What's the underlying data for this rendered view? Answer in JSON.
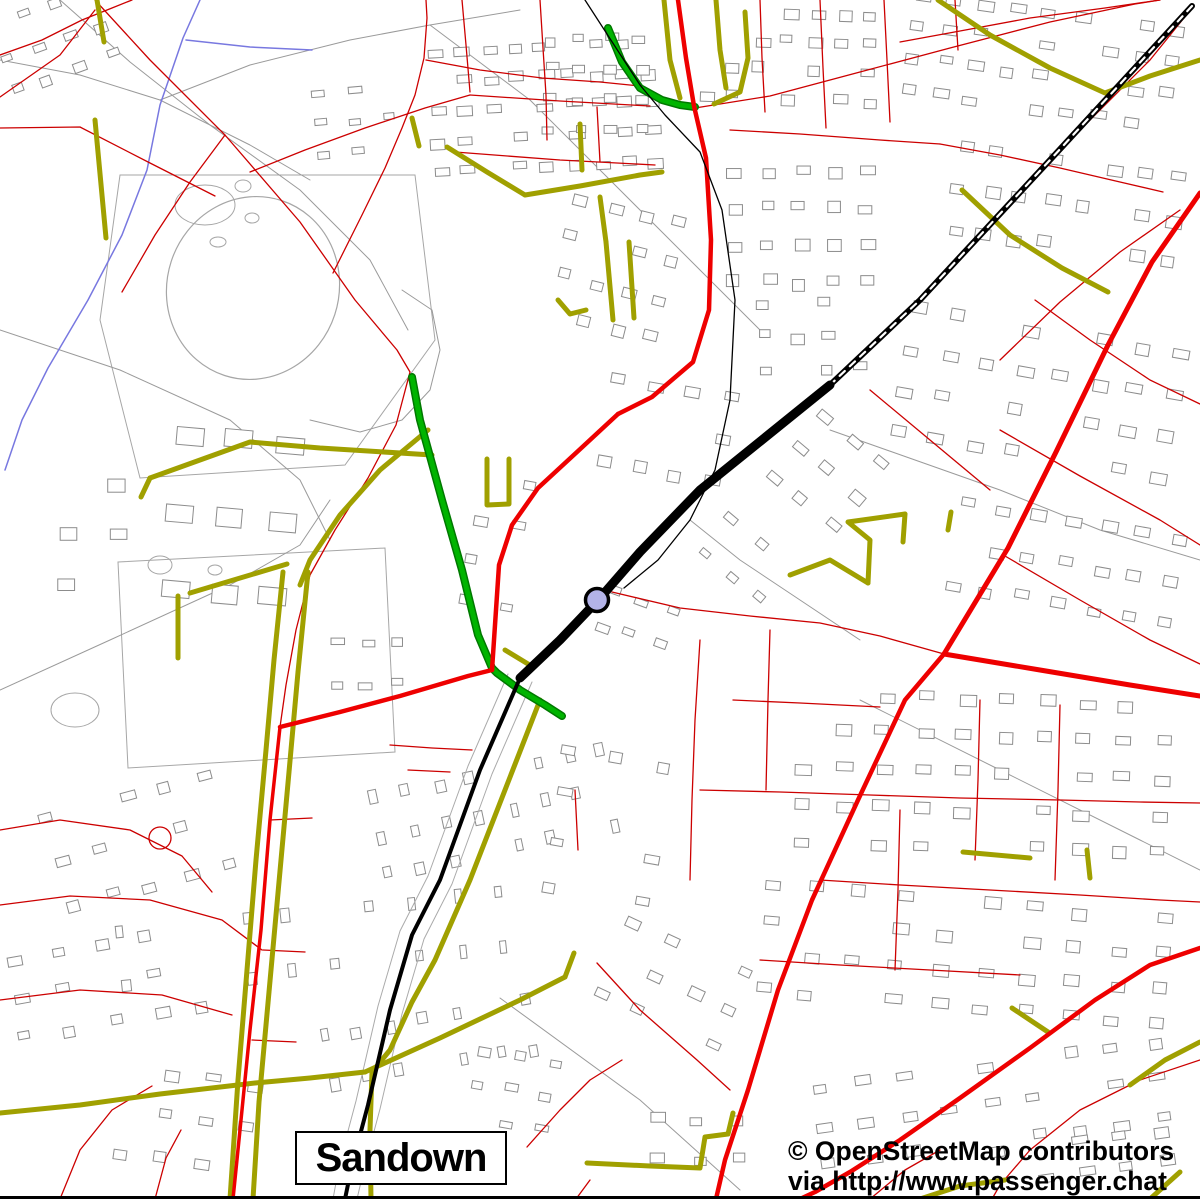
{
  "map_view": {
    "width": 1200,
    "height": 1199,
    "place_label": "Sandown",
    "attribution_line1": "© OpenStreetMap contributors",
    "attribution_line2": "via http://www.passenger.chat",
    "palette": {
      "background": "#ffffff",
      "building": "#8c8c8c",
      "path_gray": "#9a9a9a",
      "field_gray": "#a6a6a6",
      "minor_road": "#cc0000",
      "major_road": "#ee0000",
      "secondary_road": "#a0a000",
      "tertiary_green": "#00b400",
      "tertiary_green_edge": "#007800",
      "railway": "#000000",
      "stream": "#7878e0",
      "marker_fill": "#b3b3e8",
      "marker_stroke": "#000000"
    },
    "station_marker": {
      "x": 597,
      "y": 600,
      "r": 11.5,
      "stroke_width": 3.5
    },
    "layers": {
      "streams": [
        "200,0 183,38 160,105 147,170 122,235 88,300 48,368 22,420 5,470",
        "186,40 250,47 312,50"
      ],
      "fields": [
        "120,175 415,175 435,340 345,465 140,478 100,320",
        "118,562 385,548 395,752 128,768"
      ],
      "oval_track": {
        "cx": 253,
        "cy": 288,
        "rx": 86,
        "ry": 92,
        "rotate": 18
      },
      "ponds": [
        [
          205,
          205,
          30,
          20
        ],
        [
          243,
          186,
          8,
          6
        ],
        [
          252,
          218,
          7,
          5
        ],
        [
          218,
          242,
          8,
          5
        ],
        [
          160,
          565,
          12,
          9
        ],
        [
          75,
          710,
          24,
          17
        ],
        [
          215,
          570,
          7,
          5
        ]
      ],
      "paths": [
        "60,0 130,62 210,125 300,190 370,260 408,330",
        "0,60 80,75 160,100 250,145 310,180",
        "160,100 250,65 350,40 430,25 520,10",
        "0,330 120,370 230,420 300,480 330,540",
        "0,690 110,640 230,585 300,545 330,500",
        "500,998 640,1100 740,1190",
        "310,420 360,432 402,420 430,390 440,350 432,310 402,290",
        "430,25 530,100 620,190 700,270 760,330",
        "830,430 1000,490 1100,530 1200,560",
        "860,700 1000,770 1140,840 1200,870",
        "690,520 740,560 800,600 860,640"
      ],
      "building_clusters": [
        [
          432,
          42,
          240,
          150,
          -3,
          5,
          9,
          14,
          9
        ],
        [
          700,
          8,
          190,
          115,
          2,
          4,
          7,
          13,
          9
        ],
        [
          905,
          8,
          290,
          130,
          8,
          4,
          9,
          14,
          9
        ],
        [
          950,
          158,
          245,
          125,
          8,
          3,
          8,
          14,
          10
        ],
        [
          728,
          168,
          165,
          145,
          0,
          4,
          5,
          13,
          10
        ],
        [
          556,
          208,
          135,
          155,
          14,
          4,
          4,
          12,
          10
        ],
        [
          600,
          385,
          150,
          125,
          10,
          3,
          4,
          14,
          10
        ],
        [
          758,
          298,
          125,
          100,
          0,
          3,
          4,
          12,
          9
        ],
        [
          898,
          328,
          300,
          165,
          10,
          4,
          8,
          15,
          10
        ],
        [
          948,
          518,
          250,
          125,
          10,
          3,
          7,
          14,
          10
        ],
        [
          770,
          430,
          115,
          120,
          40,
          3,
          3,
          13,
          9
        ],
        [
          795,
          695,
          400,
          185,
          2,
          5,
          10,
          15,
          10
        ],
        [
          758,
          898,
          440,
          140,
          5,
          4,
          10,
          15,
          10
        ],
        [
          818,
          1058,
          380,
          115,
          -8,
          3,
          9,
          14,
          9
        ],
        [
          428,
          695,
          115,
          265,
          78,
          8,
          3,
          12,
          8
        ],
        [
          548,
          755,
          145,
          185,
          10,
          4,
          3,
          13,
          9
        ],
        [
          598,
          945,
          165,
          120,
          25,
          3,
          4,
          13,
          9
        ],
        [
          372,
          945,
          95,
          235,
          80,
          7,
          2,
          12,
          8
        ],
        [
          240,
          755,
          115,
          420,
          84,
          10,
          2,
          12,
          8
        ],
        [
          55,
          785,
          205,
          140,
          -15,
          3,
          5,
          13,
          9
        ],
        [
          15,
          935,
          225,
          120,
          -10,
          3,
          5,
          13,
          9
        ],
        [
          115,
          1075,
          165,
          125,
          8,
          3,
          4,
          13,
          9
        ],
        [
          165,
          432,
          150,
          230,
          5,
          3,
          3,
          26,
          18
        ],
        [
          425,
          475,
          125,
          165,
          10,
          4,
          3,
          12,
          8
        ],
        [
          0,
          0,
          135,
          100,
          -20,
          3,
          4,
          12,
          8
        ],
        [
          315,
          85,
          105,
          95,
          -5,
          3,
          3,
          12,
          8
        ],
        [
          995,
          1135,
          205,
          62,
          -8,
          2,
          5,
          14,
          9
        ],
        [
          470,
          1055,
          105,
          100,
          10,
          3,
          3,
          12,
          8
        ],
        [
          650,
          1115,
          125,
          80,
          0,
          2,
          3,
          13,
          9
        ],
        [
          545,
          35,
          120,
          120,
          0,
          4,
          4,
          11,
          8
        ],
        [
          595,
          600,
          90,
          70,
          20,
          2,
          3,
          12,
          8
        ],
        [
          690,
          540,
          110,
          80,
          40,
          2,
          3,
          12,
          8
        ],
        [
          330,
          640,
          90,
          80,
          0,
          2,
          3,
          12,
          8
        ],
        [
          60,
          430,
          100,
          200,
          0,
          4,
          2,
          16,
          12
        ]
      ],
      "minor_roads": [
        "0,97 60,55 95,10",
        "95,0 150,60 225,135 300,222 355,300 397,350 410,372 396,425 368,478 335,530 310,575 296,630 286,685 280,727",
        "0,128 80,127 150,163 215,196",
        "225,135 190,182 155,235 122,292",
        "250,172 305,150 365,128 425,108 470,95",
        "333,273 362,215 385,168 402,128 415,95 424,58 427,18 426,0",
        "426,60 480,70 542,78 600,82 640,86",
        "462,0 466,45 470,92",
        "540,0 543,48 546,95 547,140",
        "470,95 560,101 650,106",
        "455,152 560,160 655,165",
        "597,107 600,162",
        "695,108 770,96 860,72 950,48 1050,22 1135,4 1160,0",
        "760,0 762,58 765,112",
        "820,0 823,68 826,128",
        "884,0 887,60 890,122",
        "730,130 800,134 880,140 940,144",
        "940,144 1000,155 1060,168 1120,182 1163,192",
        "900,42 960,31 1030,18 1105,8 1160,0",
        "920,300 1000,215 1080,130 1150,60 1192,8",
        "1000,360 1060,302 1120,252 1180,210",
        "1000,430 1080,476 1160,520 1200,545",
        "1005,556 1080,600 1150,640 1200,664",
        "1035,300 1090,340 1150,380 1200,404",
        "870,390 930,440 990,490",
        "612,592 680,608 750,616 820,623 880,636 944,654",
        "700,640 695,720 692,800 690,880",
        "770,630 768,700 766,790",
        "700,790 780,792 870,795 960,798 1060,800 1140,802 1200,803",
        "733,700 800,703 880,707",
        "980,700 978,780 975,860",
        "1060,705 1058,790 1055,880",
        "900,810 898,890 895,970",
        "820,880 900,885 990,890 1080,895 1160,900 1200,902",
        "760,960 840,965 930,970 1020,975",
        "1200,1060 1140,1080 1080,1110 1030,1150 1000,1185 992,1199",
        "597,963 640,1010 697,1060 730,1090",
        "527,1147 560,1110 590,1080 622,1060",
        "590,1180 576,1199",
        "0,830 60,820 130,830 182,856 212,892",
        "0,905 70,896 150,900 222,920 262,950",
        "0,1000 80,990 162,995 232,1015",
        "60,1199 80,1150 112,1110 152,1086",
        "155,1199 166,1158 181,1130",
        "263,950 305,952",
        "270,820 312,818",
        "252,1040 296,1042",
        "390,745 432,748 472,750",
        "575,790 578,850",
        "0,55 42,40 82,20 112,8 132,0",
        "408,770 450,772",
        "870,1199 905,1170 940,1150",
        "955,0 958,50"
      ],
      "minor_circles": [
        [
          160,
          838,
          11
        ]
      ],
      "secondary_roads": [
        "447,147 487,172 525,195",
        "525,195 580,186 640,175 662,172",
        "580,124 582,170",
        "600,197 606,242",
        "606,242 613,320",
        "629,242 634,318",
        "558,300 570,314 586,310",
        "97,0 104,42",
        "95,120 106,238",
        "412,118 419,146",
        "664,0 670,60 680,98",
        "716,0 720,50 726,88",
        "745,12 748,58 740,92 714,104",
        "938,0 990,35 1050,68 1105,93 1150,76 1200,60",
        "962,190 1010,235 1062,268 1108,292",
        "150,478 250,442 320,448 432,455",
        "150,478 141,497",
        "428,430 380,470 340,515 310,560 300,585",
        "283,572 274,660 266,750 256,860 247,970 238,1080 230,1199",
        "308,572 298,672 289,772 279,882 269,992 259,1102 253,1199",
        "190,593 287,564",
        "178,596 178,658",
        "505,650 533,667",
        "540,700 505,790 470,880 435,960 412,1002 390,1050 372,1072",
        "372,1072 370,1130 371,1199",
        "0,1113 80,1105 160,1094 255,1083 310,1078 365,1072",
        "365,1072 440,1038 520,1000 565,977",
        "565,977 574,953",
        "587,1163 650,1166 700,1168 705,1137 728,1134 733,1113",
        "920,1199 960,1186 1005,1180",
        "1130,1085 1165,1060 1200,1042",
        "1012,1008 1048,1032",
        "963,852 1030,858",
        "1087,850 1090,878",
        "487,459 487,505 509,504 509,459",
        "868,583 870,540 848,522 905,514",
        "905,514 903,542",
        "948,530 951,512",
        "790,575 830,560 868,583",
        "1150,1199 1180,1172"
      ],
      "tertiary_roads": [
        "608,28 622,62 640,88 662,100 680,105 695,107",
        "412,377 420,420 442,500 462,570 478,635 492,668 497,673 520,690 545,705 562,716"
      ],
      "major_roads": [
        {
          "p": "678,0 686,58 694,106 706,158 711,240 709,310 693,362 652,397 618,414",
          "w": 4.5
        },
        {
          "p": "618,414 577,452 538,488 512,525 499,565 495,625 492,670",
          "w": 4.5
        },
        {
          "p": "492,670 468,676 400,696 340,712 280,727",
          "w": 4.5
        },
        {
          "p": "280,727 270,820 261,930 250,1030 241,1120 233,1199",
          "w": 3.5
        },
        {
          "p": "1200,193 1152,262 1108,345 1056,452 1008,548 944,654",
          "w": 5
        },
        {
          "p": "944,654 1040,670 1130,685 1200,696",
          "w": 5
        },
        {
          "p": "944,654 905,700 858,800 812,900 778,990 748,1090 725,1160 716,1199",
          "w": 4.5
        },
        {
          "p": "1200,948 1150,965 1095,1000 1030,1048 960,1098 900,1140 850,1172 815,1192 800,1199",
          "w": 4.5
        }
      ],
      "railways": {
        "main_ne": "1192,6 1050,160 920,300 830,385",
        "station_band": "830,385 700,490 640,552 600,598 560,640 520,678",
        "sw_line": "520,678 480,770 440,880 412,935 390,1010 368,1105 352,1165 345,1199",
        "sw_gray_east": "532,682 492,774 452,884 424,939 402,1014 380,1109 364,1169 357,1199",
        "sw_gray_west": "508,674 468,766 428,876 400,931 378,1006 356,1101 340,1161 333,1199",
        "branch": "585,0 640,85 665,115 700,152 722,210 735,300 730,400 715,470 690,520 658,560 624,588"
      }
    }
  }
}
